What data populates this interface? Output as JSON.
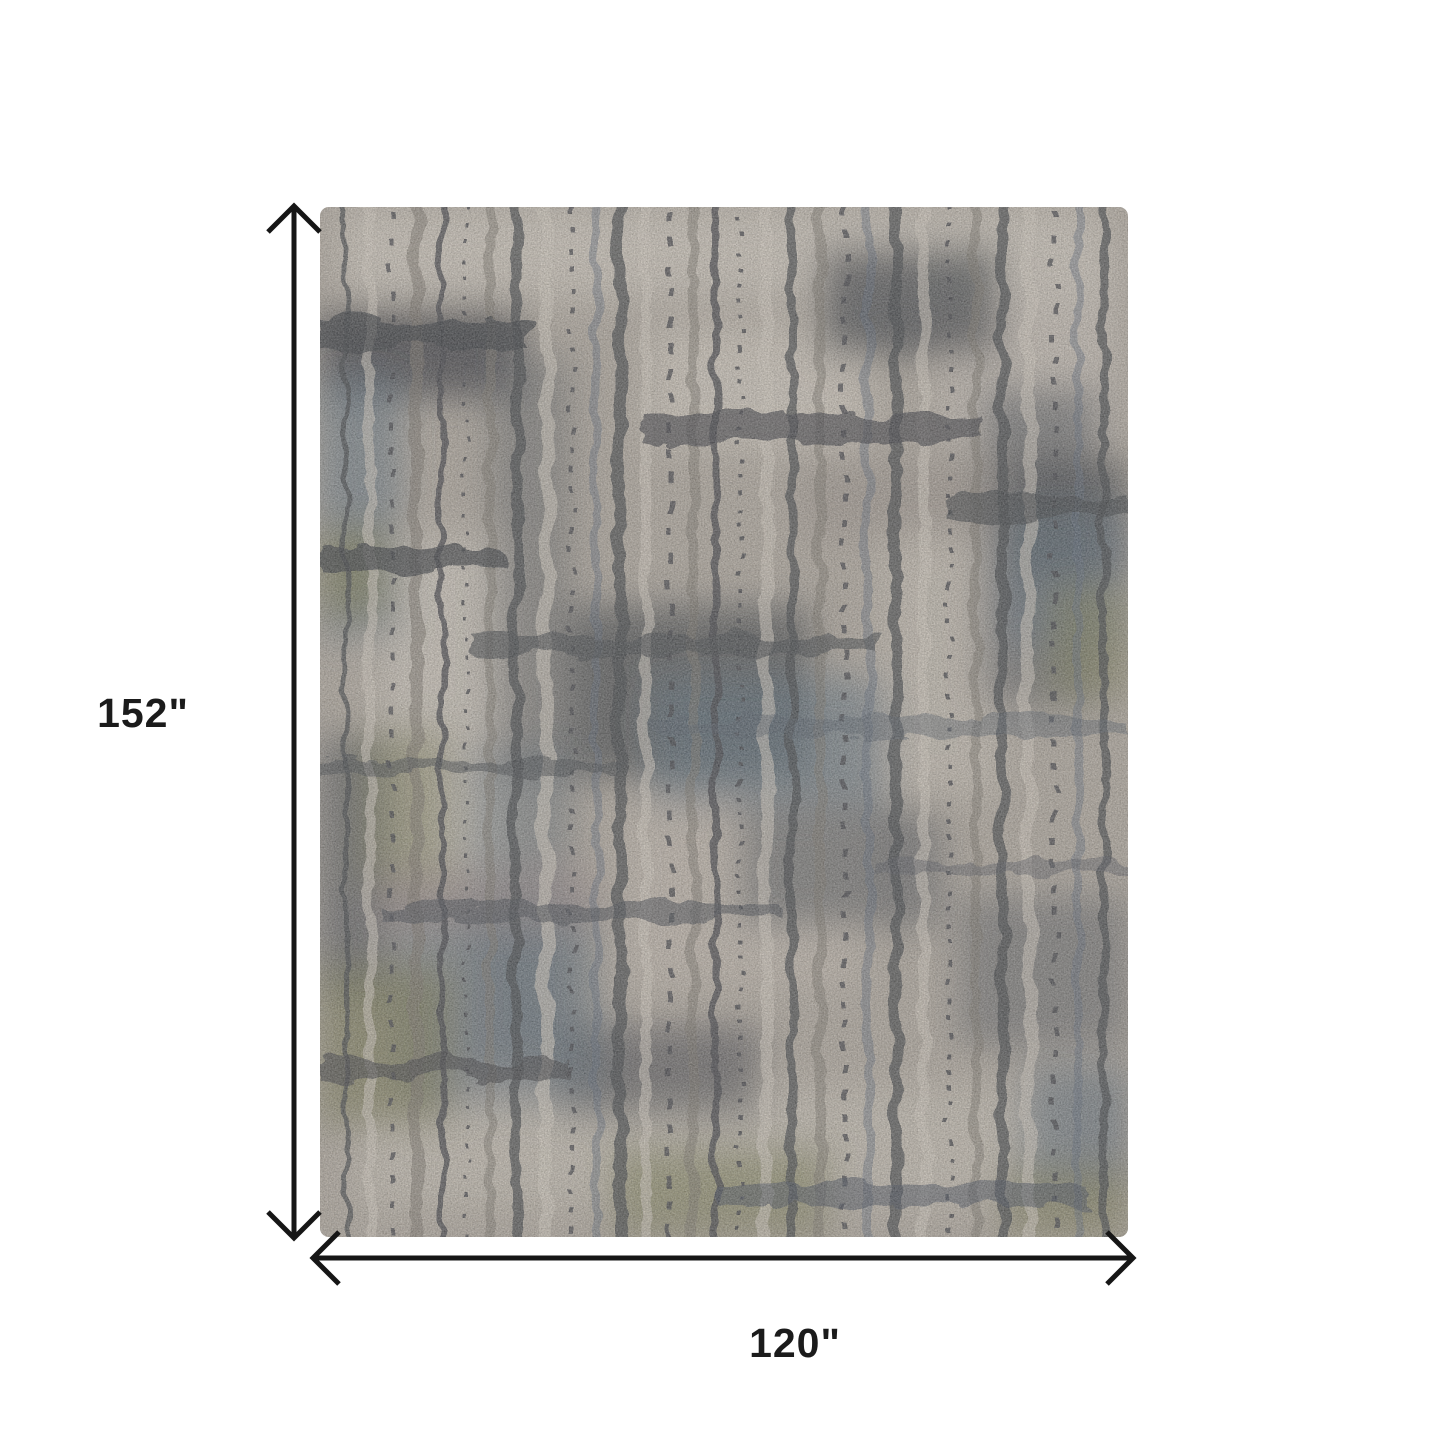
{
  "canvas": {
    "background": "#ffffff"
  },
  "diagram": {
    "height_label": "152\"",
    "width_label": "120\"",
    "arrow_color": "#161616",
    "label_color": "#1b1b1b"
  },
  "rug": {
    "palette": {
      "base": "#b3aba0",
      "cream": "#d5cdc1",
      "dark_charcoal": "#45474b",
      "taupe": "#7d766c",
      "blue_gray": "#5d6e7d",
      "olive": "#79794f",
      "mauve": "#9b8a8a"
    }
  }
}
